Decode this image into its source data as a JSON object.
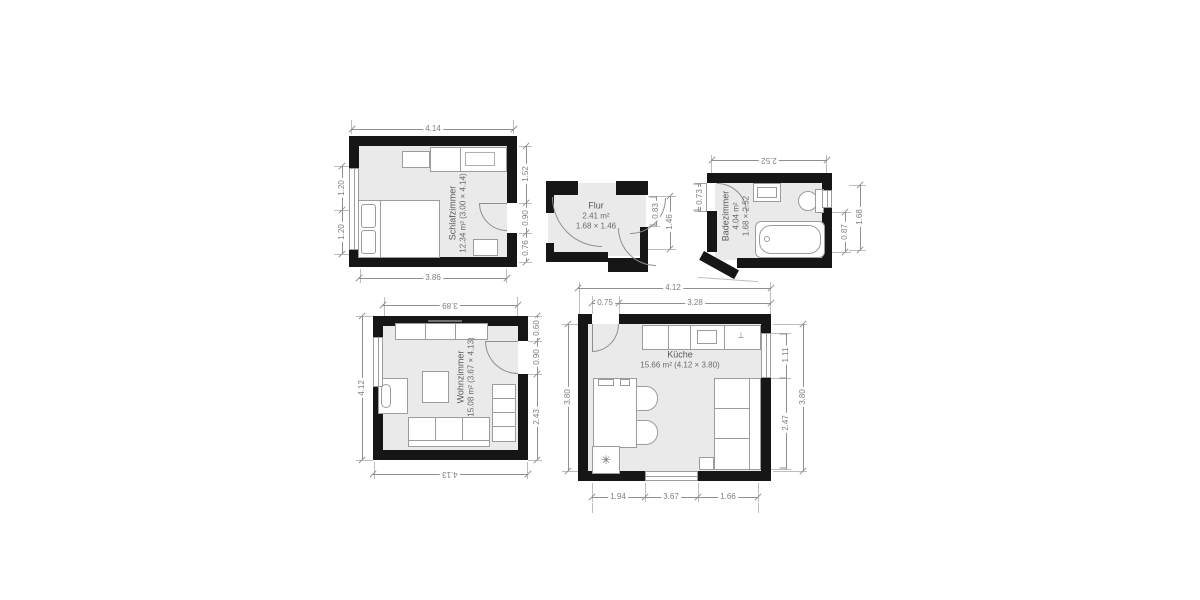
{
  "rooms": {
    "schlafzimmer": {
      "name": "Schlafzimmer",
      "area": "12.34 m² (3.00 × 4.14)"
    },
    "flur": {
      "name": "Flur",
      "area": "2.41 m²",
      "size": "1.68 × 1.46"
    },
    "badezimmer": {
      "name": "Badezimmer",
      "area": "4.04 m²",
      "size": "1.68 × 2.52"
    },
    "wohnzimmer": {
      "name": "Wohnzimmer",
      "area": "15.08 m² (3.67 × 4.13)"
    },
    "kueche": {
      "name": "Küche",
      "area": "15.66 m² (4.12 × 3.80)"
    }
  },
  "dims": {
    "schlafzimmer": {
      "top": "4.14",
      "bottom": "3.86",
      "left_upper": "1.20",
      "left_lower": "1.20",
      "right_upper": "1.52",
      "right_mid": "0.90",
      "right_lower": "0.76"
    },
    "flur": {
      "door": "0.83",
      "width": "1.46"
    },
    "badezimmer": {
      "top": "2.52",
      "left": "0.73",
      "right_inner": "0.87",
      "right_outer": "1.68"
    },
    "wohnzimmer": {
      "top": "3.89",
      "bottom": "4.13",
      "left": "4.12",
      "right_upper": "0.60",
      "right_mid": "0.90",
      "right_lower": "2.43"
    },
    "kueche": {
      "top": "4.12",
      "top_left": "0.75",
      "top_right": "3.28",
      "left": "3.80",
      "right_upper": "1.11",
      "right_lower": "2.47",
      "right_outer": "3.80",
      "bottom_left": "1.94",
      "bottom_mid": "3.67",
      "bottom_right": "1.66"
    }
  },
  "symbols": {
    "freezer": "✳",
    "faucet": "⊥"
  },
  "colors": {
    "wall": "#161616",
    "floor": "#eaeaea",
    "dimension": "#8f8f8f",
    "label": "#595959",
    "furniture_outline": "#9c9c9c",
    "background": "#ffffff"
  }
}
